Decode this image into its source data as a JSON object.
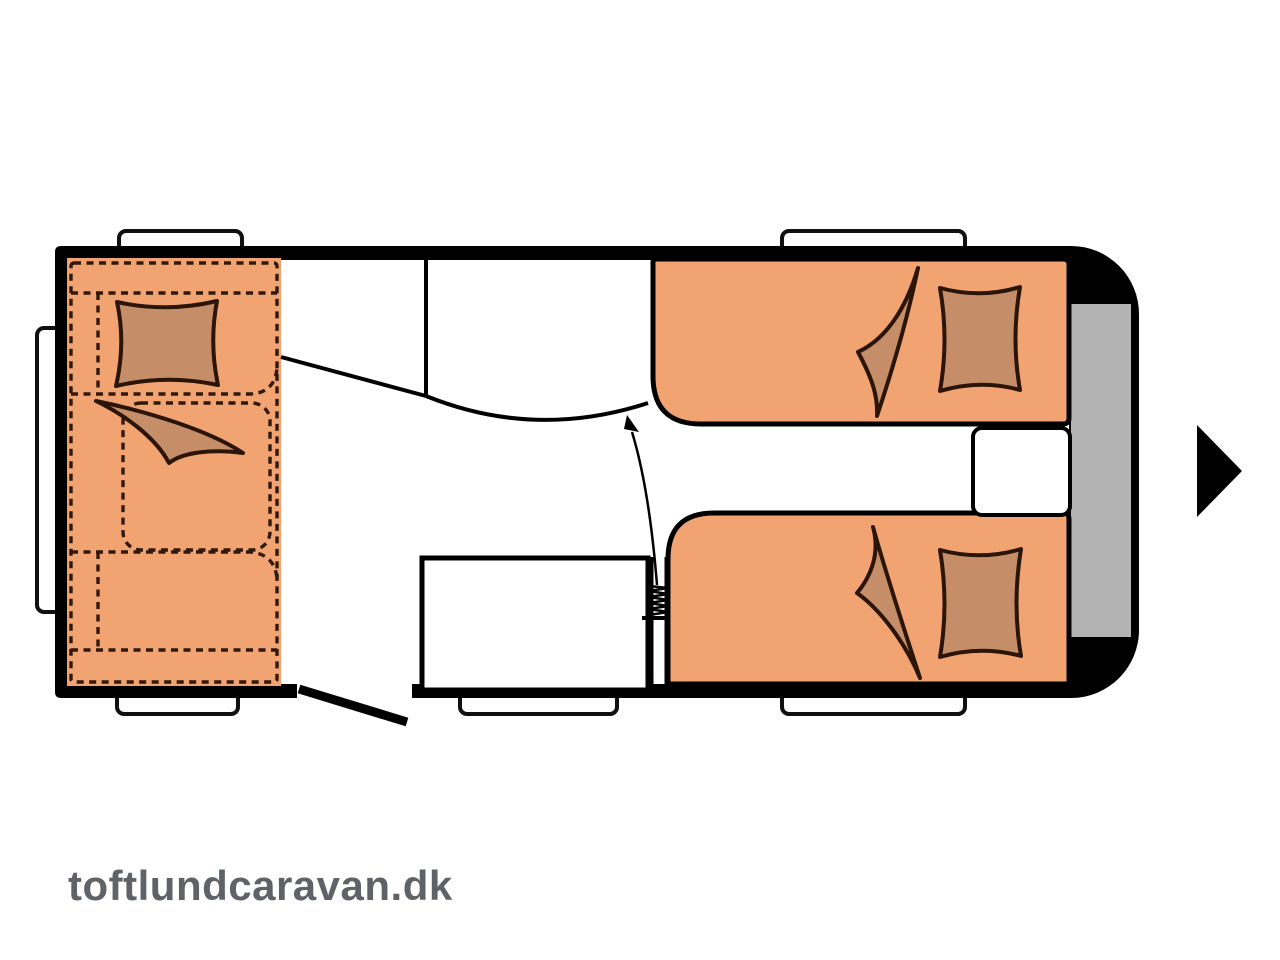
{
  "watermark": {
    "text": "toftlundcaravan.dk",
    "color": "#5f6368"
  },
  "colors": {
    "background": "#ffffff",
    "wall_outline": "#000000",
    "furniture_orange": "#F1A471",
    "cushion_brown": "#C68E68",
    "cushion_outline": "#2b1508",
    "dashed_line": "#30190a",
    "front_storage_gray": "#b3b3b3",
    "watermark_gray": "#5f6368"
  },
  "floorplan": {
    "type": "caravan-layout",
    "icon_names": [
      "rear-lounge",
      "lounge-pillow",
      "lounge-blanket",
      "washroom-wall",
      "wardrobe-diagonal",
      "kitchen-block",
      "heater-coil",
      "entrance-door",
      "single-bed-top",
      "single-bed-bottom",
      "bed-pillow",
      "bed-blanket",
      "bedside-cabinet",
      "front-storage",
      "entry-arrow",
      "drawbar-arrow",
      "window-bump"
    ],
    "window_count": 6
  }
}
